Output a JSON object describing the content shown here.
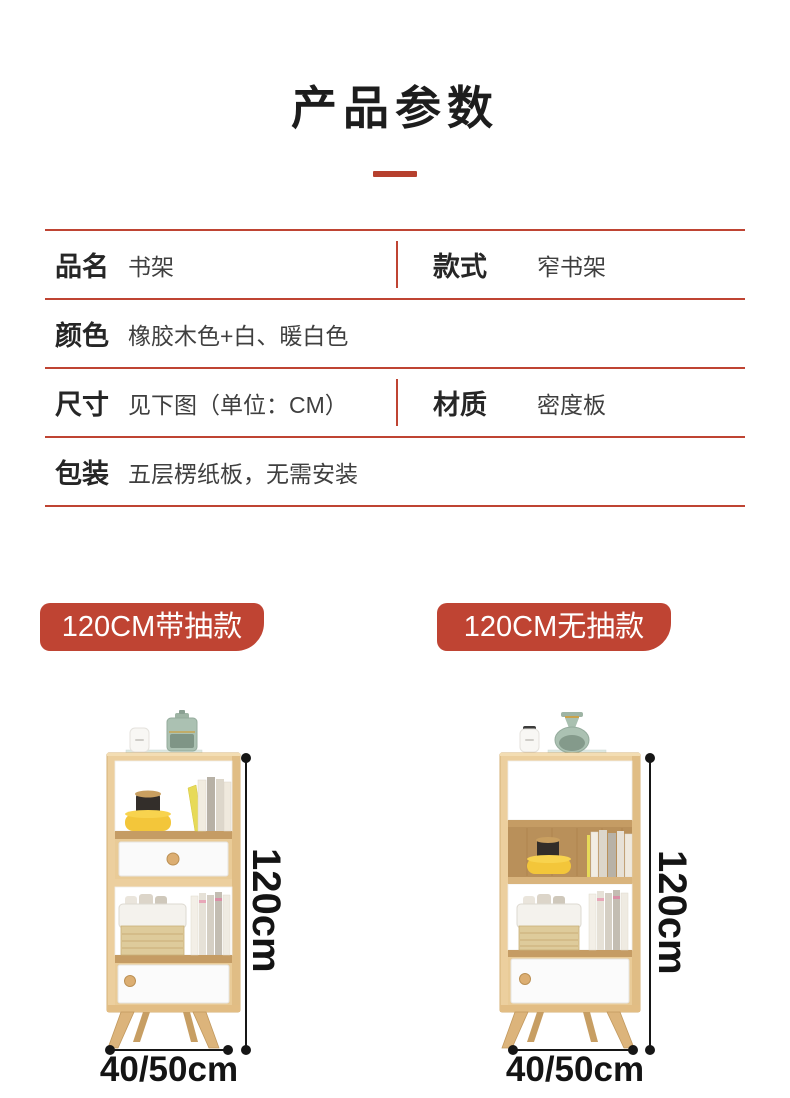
{
  "page_title": "产品参数",
  "spec_table": {
    "rows": [
      {
        "cells": [
          {
            "label": "品名",
            "value": "书架"
          },
          {
            "label": "款式",
            "value": "窄书架"
          }
        ]
      },
      {
        "cells": [
          {
            "label": "颜色",
            "value": "橡胶木色+白、暖白色"
          }
        ]
      },
      {
        "cells": [
          {
            "label": "尺寸",
            "value": "见下图（单位：CM）"
          },
          {
            "label": "材质",
            "value": "密度板"
          }
        ]
      },
      {
        "cells": [
          {
            "label": "包装",
            "value": "五层楞纸板，无需安装"
          }
        ]
      }
    ]
  },
  "variants": [
    {
      "badge": "120CM带抽款",
      "height_label": "120cm",
      "width_label": "40/50cm"
    },
    {
      "badge": "120CM无抽款",
      "height_label": "120cm",
      "width_label": "40/50cm"
    }
  ],
  "colors": {
    "accent_red": "#bf4433",
    "title_bar_red": "#b6402e",
    "dimension_black": "#141414",
    "wood_light": "#eccf9e"
  }
}
